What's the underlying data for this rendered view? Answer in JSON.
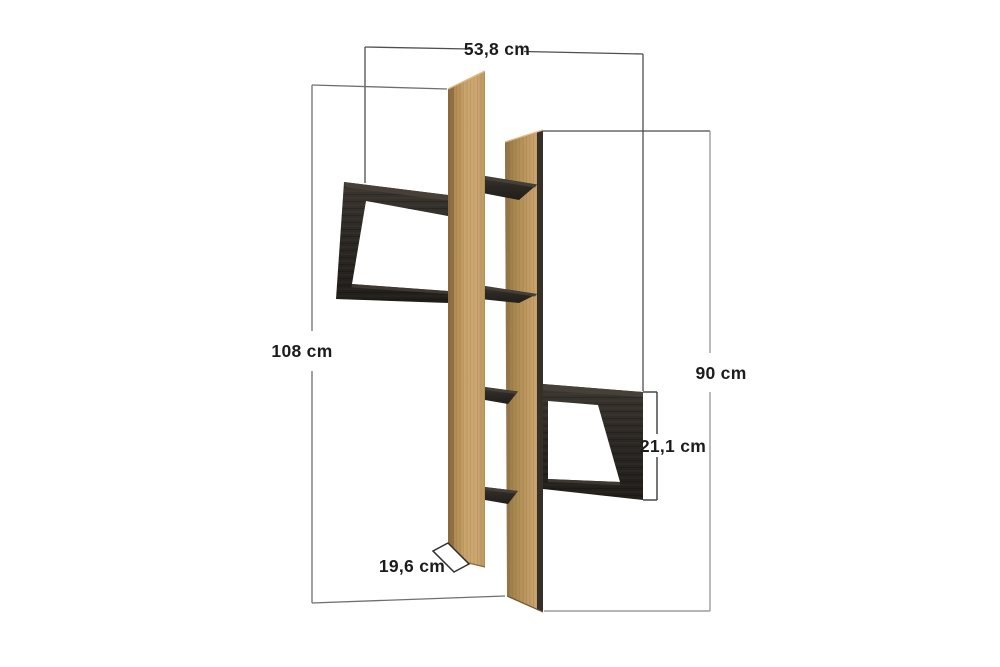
{
  "page": {
    "background": "#ffffff",
    "subject": "wall shelf unit dimension diagram"
  },
  "diagram": {
    "object": "wall-mounted shelf with two vertical oak panels and dark open box shelves",
    "view": "perspective product drawing",
    "materials": {
      "oak": "#c9a46c",
      "oak_shadow": "#9a784a",
      "oak_highlight": "#dbb77f",
      "dark_wood": "#2b2723",
      "dark_wood_top": "#474139"
    },
    "line_colors": {
      "dimension_dark": "#4f4f4f",
      "dimension_medium": "#6f6f6f",
      "dimension_light": "#9d9d9d",
      "bracket": "#3c3c3c",
      "depth_outline": "#2e2e2e"
    },
    "labels": {
      "width": "53,8 cm",
      "height_left": "108 cm",
      "height_right": "90 cm",
      "compartment": "21,1 cm",
      "depth": "19,6 cm"
    }
  }
}
